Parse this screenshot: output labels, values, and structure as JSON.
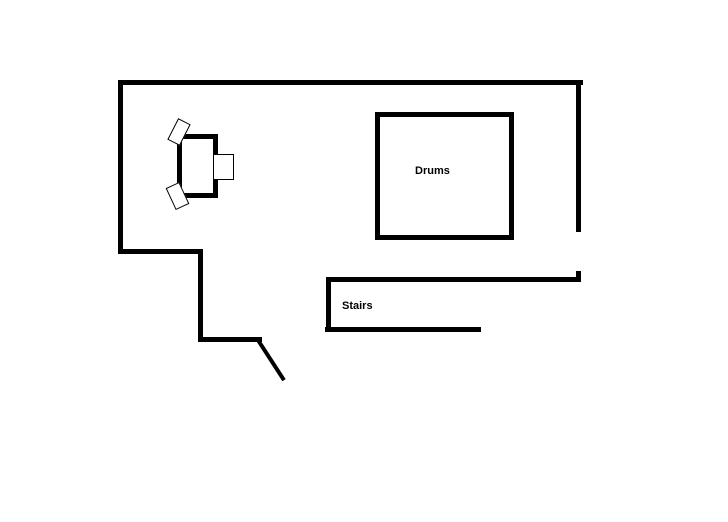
{
  "diagram": {
    "kind": "hand-drawn floor plan sketch",
    "background_color": "#ffffff",
    "line_color": "#000000",
    "areas": {
      "drums": {
        "label": "Drums"
      },
      "stairs": {
        "label": "Stairs"
      }
    }
  }
}
